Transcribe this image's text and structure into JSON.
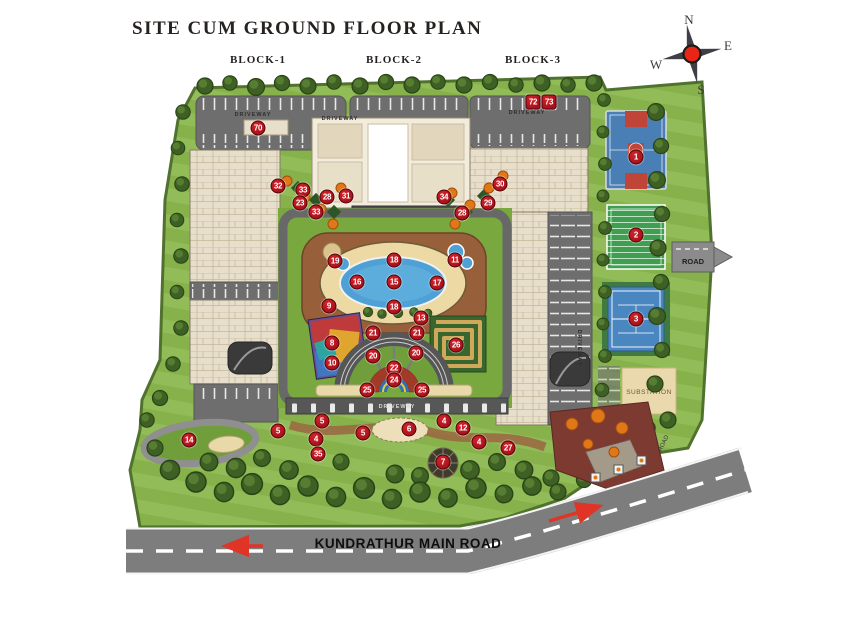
{
  "page": {
    "title": "SITE CUM GROUND FLOOR PLAN"
  },
  "blocks": [
    {
      "label": "BLOCK-1"
    },
    {
      "label": "BLOCK-2"
    },
    {
      "label": "BLOCK-3"
    }
  ],
  "compass": {
    "n": "N",
    "e": "E",
    "s": "S",
    "w": "W"
  },
  "labels": {
    "driveway": "DRIVEWAY",
    "road_right": "ROAD",
    "road_entry": "ROAD",
    "substation": "SUBSTATION",
    "main_road": "KUNDRATHUR MAIN ROAD"
  },
  "colors": {
    "marker_red": "#a8101a",
    "lawn": "#86b14b",
    "pool_blue": "#4fa0d4",
    "court_blue": "#4a7fb5",
    "court_green": "#3f9e52",
    "road_grey": "#7d7d7d",
    "paving_brown": "#98603a",
    "building_beige": "#e7dfcb",
    "substation_tan": "#ead9ad",
    "entry_maroon": "#7c3a30",
    "accent_orange": "#e07818"
  },
  "markers": [
    {
      "num": "70",
      "x": 258,
      "y": 128
    },
    {
      "num": "72",
      "x": 533,
      "y": 102,
      "shape": "sq"
    },
    {
      "num": "73",
      "x": 549,
      "y": 102,
      "shape": "sq"
    },
    {
      "num": "32",
      "x": 278,
      "y": 186
    },
    {
      "num": "33",
      "x": 303,
      "y": 190
    },
    {
      "num": "23",
      "x": 300,
      "y": 203
    },
    {
      "num": "28",
      "x": 327,
      "y": 197
    },
    {
      "num": "31",
      "x": 346,
      "y": 196
    },
    {
      "num": "33",
      "x": 316,
      "y": 212
    },
    {
      "num": "34",
      "x": 444,
      "y": 197
    },
    {
      "num": "30",
      "x": 500,
      "y": 184
    },
    {
      "num": "29",
      "x": 488,
      "y": 203
    },
    {
      "num": "28",
      "x": 462,
      "y": 213
    },
    {
      "num": "1",
      "x": 636,
      "y": 157
    },
    {
      "num": "2",
      "x": 636,
      "y": 235
    },
    {
      "num": "3",
      "x": 636,
      "y": 319
    },
    {
      "num": "19",
      "x": 335,
      "y": 261
    },
    {
      "num": "18",
      "x": 394,
      "y": 260
    },
    {
      "num": "11",
      "x": 455,
      "y": 260
    },
    {
      "num": "16",
      "x": 357,
      "y": 282
    },
    {
      "num": "15",
      "x": 394,
      "y": 282
    },
    {
      "num": "17",
      "x": 437,
      "y": 283
    },
    {
      "num": "9",
      "x": 329,
      "y": 306
    },
    {
      "num": "18",
      "x": 394,
      "y": 307
    },
    {
      "num": "13",
      "x": 421,
      "y": 318
    },
    {
      "num": "21",
      "x": 373,
      "y": 333
    },
    {
      "num": "21",
      "x": 417,
      "y": 333
    },
    {
      "num": "8",
      "x": 332,
      "y": 343
    },
    {
      "num": "26",
      "x": 456,
      "y": 345
    },
    {
      "num": "20",
      "x": 373,
      "y": 356
    },
    {
      "num": "20",
      "x": 416,
      "y": 353
    },
    {
      "num": "10",
      "x": 332,
      "y": 363
    },
    {
      "num": "22",
      "x": 394,
      "y": 368
    },
    {
      "num": "24",
      "x": 394,
      "y": 380
    },
    {
      "num": "25",
      "x": 367,
      "y": 390
    },
    {
      "num": "25",
      "x": 422,
      "y": 390
    },
    {
      "num": "14",
      "x": 189,
      "y": 440
    },
    {
      "num": "5",
      "x": 278,
      "y": 431
    },
    {
      "num": "5",
      "x": 322,
      "y": 421
    },
    {
      "num": "4",
      "x": 316,
      "y": 439
    },
    {
      "num": "35",
      "x": 318,
      "y": 454
    },
    {
      "num": "5",
      "x": 363,
      "y": 433
    },
    {
      "num": "6",
      "x": 409,
      "y": 429
    },
    {
      "num": "4",
      "x": 444,
      "y": 421
    },
    {
      "num": "12",
      "x": 463,
      "y": 428
    },
    {
      "num": "4",
      "x": 479,
      "y": 442
    },
    {
      "num": "27",
      "x": 508,
      "y": 448
    },
    {
      "num": "7",
      "x": 443,
      "y": 462
    }
  ]
}
